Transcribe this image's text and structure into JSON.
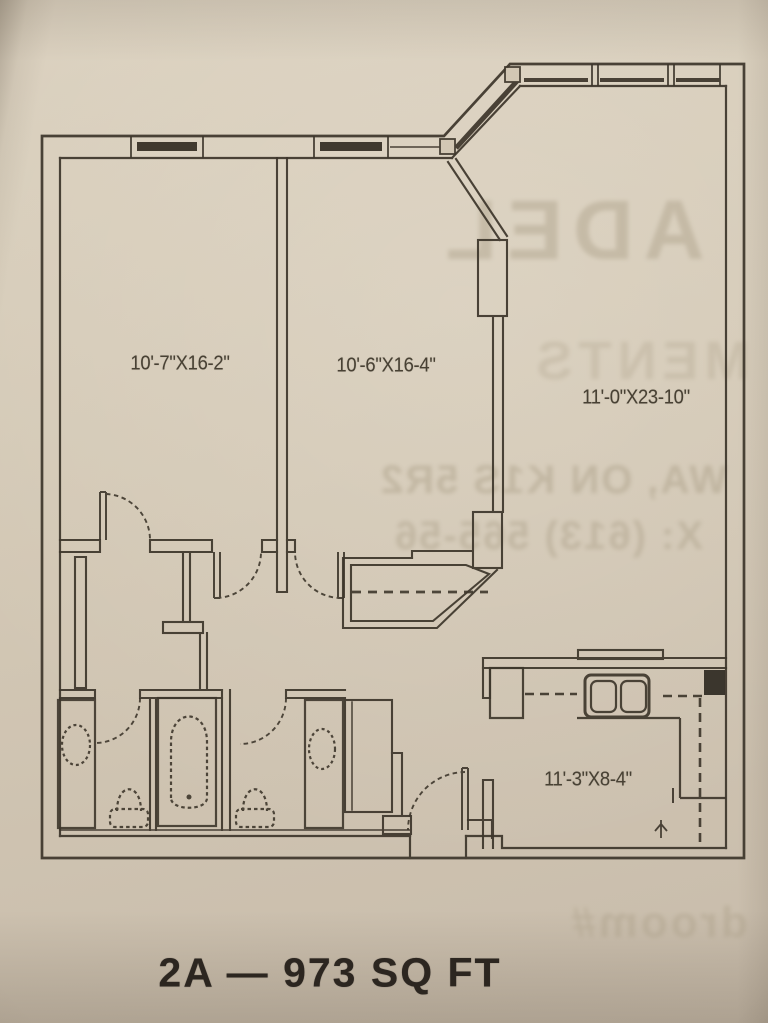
{
  "photo": {
    "kind": "scanned floor plan on beige paper",
    "paper_color": "#d3c8b5",
    "line_color": "#3e372c"
  },
  "plan": {
    "unit_title": "2A — 973 SQ FT",
    "rooms": [
      {
        "name": "bedroom-1",
        "dimensions": "10'-7\"X16-2\""
      },
      {
        "name": "bedroom-2",
        "dimensions": "10'-6\"X16-4\""
      },
      {
        "name": "living-room",
        "dimensions": "11'-0\"X23-10\""
      },
      {
        "name": "kitchen",
        "dimensions": "11'-3\"X8-4\""
      }
    ]
  },
  "bleed_through_text": {
    "note": "faint mirrored print showing through from reverse side of page",
    "line1": "ADEL",
    "line2": "MENTS",
    "line3": "WA, ON K1S 5R2",
    "line4": "X: (613) 565-56",
    "line5": "droom#"
  }
}
